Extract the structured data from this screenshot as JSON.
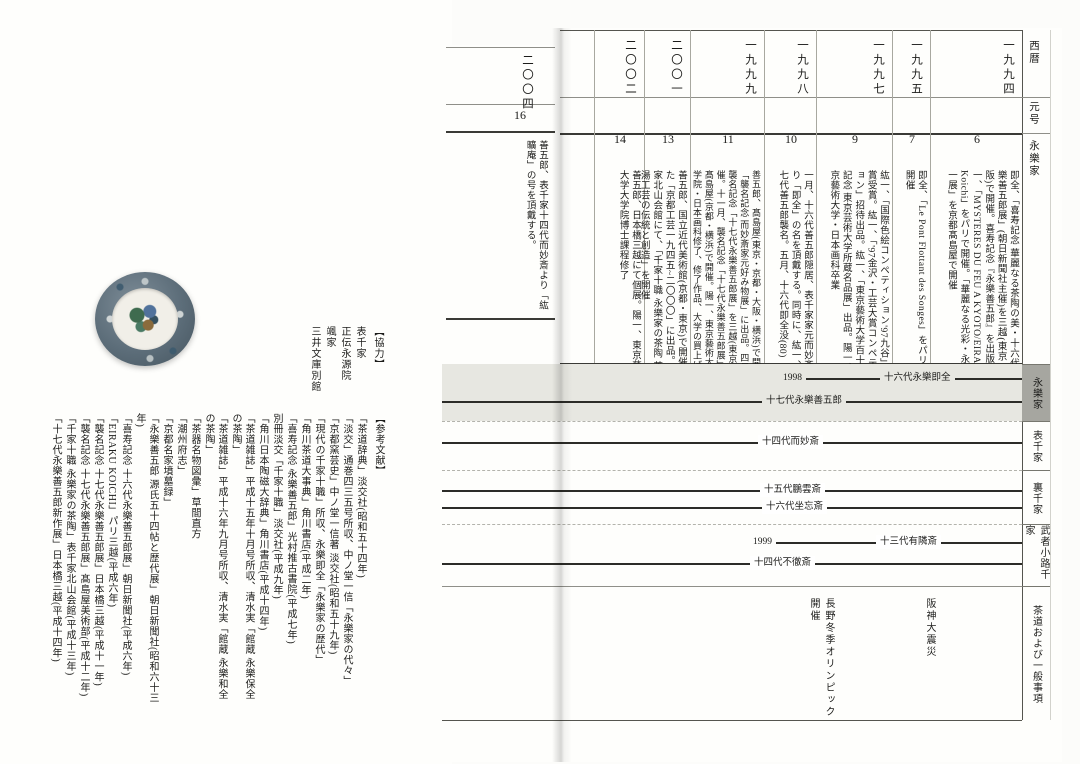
{
  "right_page": {
    "sidebar": {
      "seireki": "西暦",
      "gengo": "元号",
      "eirakuke": "永樂家"
    },
    "tabs": [
      {
        "label": "永樂家"
      },
      {
        "label": "表千家"
      },
      {
        "label": "裏千家"
      },
      {
        "label": "武者小路千家"
      },
      {
        "label": "茶道および一般事項"
      }
    ],
    "chronology": [
      {
        "year": "一九九四",
        "era": "6",
        "text": "即全、「喜寿記念 華麗なる茶陶の美・十六代永樂善五郎展」(朝日新聞社主催)を三越(東京・大阪)で開催。喜寿記念『永樂善五郎』を出版。紘一、「MYSTERES DU FEU A KYOTO/EIRAKU Koichi」をパリで開催。「華麗なる光彩・永樂紘一展」を京都髙島屋で開催"
      },
      {
        "year": "一九九五",
        "era": "7",
        "text": "即全、「Le Pont Flottant des Songes」をパリにて開催"
      },
      {
        "year": "一九九七",
        "era": "9",
        "text": "紘一、「国際色絵コンペティション'97九谷」で金賞受賞。紘一、「'97金沢・工芸大賞コンペティション」招待出品。紘一、「東京藝術大学百十周年記念 東京芸術大学所蔵名品展」出品。陽一、東京藝術大学・日本画科卒業"
      },
      {
        "year": "一九九八",
        "era": "10",
        "text": "一月、十六代善五郎隠居、表千家家元而妙斎より「即全」の名を頂戴する。同時に、紘一、十七代善五郎襲名。五月、十六代即全没(80)"
      },
      {
        "year": "一九九九",
        "era": "11",
        "text": "善五郎、髙島屋(東京・京都・大阪・横浜)で開催の「襲名記念 而妙斎家元好み物展」に出品。四月、襲名記念「十七代永樂善五郎展」を三越(東京)で開催。十一月、襲名記念「十七代永樂善五郎展」を髙島屋(京都・横浜)で開催。陽一、東京藝術大学大学院・日本画科修了、修了作品、大学の買上げ"
      },
      {
        "year": "二〇〇一",
        "era": "13",
        "text": "善五郎、国立近代美術館(京都・東京)で開催された「京都工芸一九四五~二〇〇〇」に出品。表千家北山会館にて、「千家十職 永樂家の茶陶 茶の湯工芸の伝統と創造」を開催"
      },
      {
        "year": "二〇〇二",
        "era": "14",
        "text": "善五郎、日本橋三越にて個展。陽一、東京藝術大学大学院博士課程修了"
      }
    ],
    "timeline": {
      "lines": [
        {
          "end_label": "1998",
          "label": "十六代永樂即全"
        },
        {
          "label": "十七代永樂善五郎"
        },
        {
          "label": "十四代而妙斎"
        },
        {
          "label": "十五代鵬雲斎"
        },
        {
          "label": "十六代坐忘斎"
        },
        {
          "end_label": "1999",
          "label": "十三代有隣斎"
        },
        {
          "label": "十四代不徹斎"
        }
      ],
      "events": [
        {
          "label": "阪神大震災"
        },
        {
          "label": "長野冬季オリンピック開催"
        }
      ]
    }
  },
  "next_page_fragment": {
    "year": "二〇〇四",
    "era": "16",
    "text": "善五郎、表千家十四代而妙斎より「紘曠庵」の号を頂戴する。"
  },
  "left_page": {
    "cooperation": {
      "heading": "【協力】",
      "entries": [
        "表千家",
        "正伝永源院",
        "颯家",
        "三井文庫別館"
      ]
    },
    "references": {
      "heading": "【参考文献】",
      "entries": [
        "「茶道辞典」淡交社(昭和五十四年)",
        "「淡交」通巻四三五号所収、中ノ堂一信「永樂家の代々」",
        "「京都窯芸史」中ノ堂一信著 淡交社(昭和五十九年)",
        "「現代の千家十職」所収、永樂即全「永樂家の歴代」",
        "「角川茶道大事典」角川書店(平成二年)",
        "「喜寿記念 永樂善五郎」光村推古書院(平成七年)",
        "別冊淡交「千家十職」淡交社(平成九年)",
        "「角川日本陶磁大辞典」角川書店(平成十四年)",
        "「茶道雑誌」平成十五年十月号所収、清水実「館蔵 永樂保全の茶陶」",
        "「茶道雑誌」平成十六年九月号所収、清水実「館蔵 永樂和全の茶陶」",
        "「茶器名物図彙」草間直方",
        "「潮州府志」",
        "「京都名家墳墓録」",
        "「永樂善五郎 源氏五十四帖と歴代展」朝日新聞社(昭和六十三年)",
        "「喜寿記念 十六代永樂善五郎展」朝日新聞社(平成六年)",
        "「EIRAKU KOICHI」パリ三越(平成六年)",
        "「襲名記念 十七代永樂善五郎展」日本橋三越(平成十一年)",
        "「襲名記念 十七代永樂善五郎展」髙島屋美術部(平成十二年)",
        "「千家十職 永樂家の茶陶」表千家北山会館(平成十三年)",
        "「十七代永樂善五郎新作展」日本橋三越(平成十四年)"
      ]
    }
  }
}
